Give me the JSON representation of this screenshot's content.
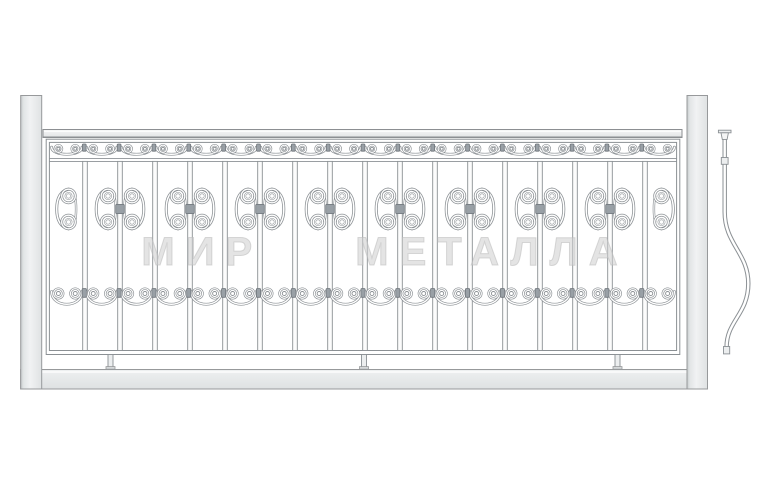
{
  "watermark": {
    "text": "МИР МЕТАЛЛА"
  },
  "drawing": {
    "butterfly_ornament_count": 8,
    "plain_bar_count": 9,
    "top_scroll_band_unit_count": 18,
    "bottom_scroll_row_unit_count": 18,
    "foot_support_count": 3
  },
  "colors": {
    "background": "#ffffff",
    "line": "#8b9094",
    "inner_white": "#ffffff",
    "bar_fill": "#fcfcfc",
    "metal_fill": "#eceeef",
    "post_fill_dark": "#c7cbcd",
    "post_fill_light": "#f1f2f3",
    "post_border": "#97999b",
    "clamp_fill": "#99a0a6",
    "clamp_border": "#6f757b",
    "watermark_fill": "#cdcdcd"
  }
}
